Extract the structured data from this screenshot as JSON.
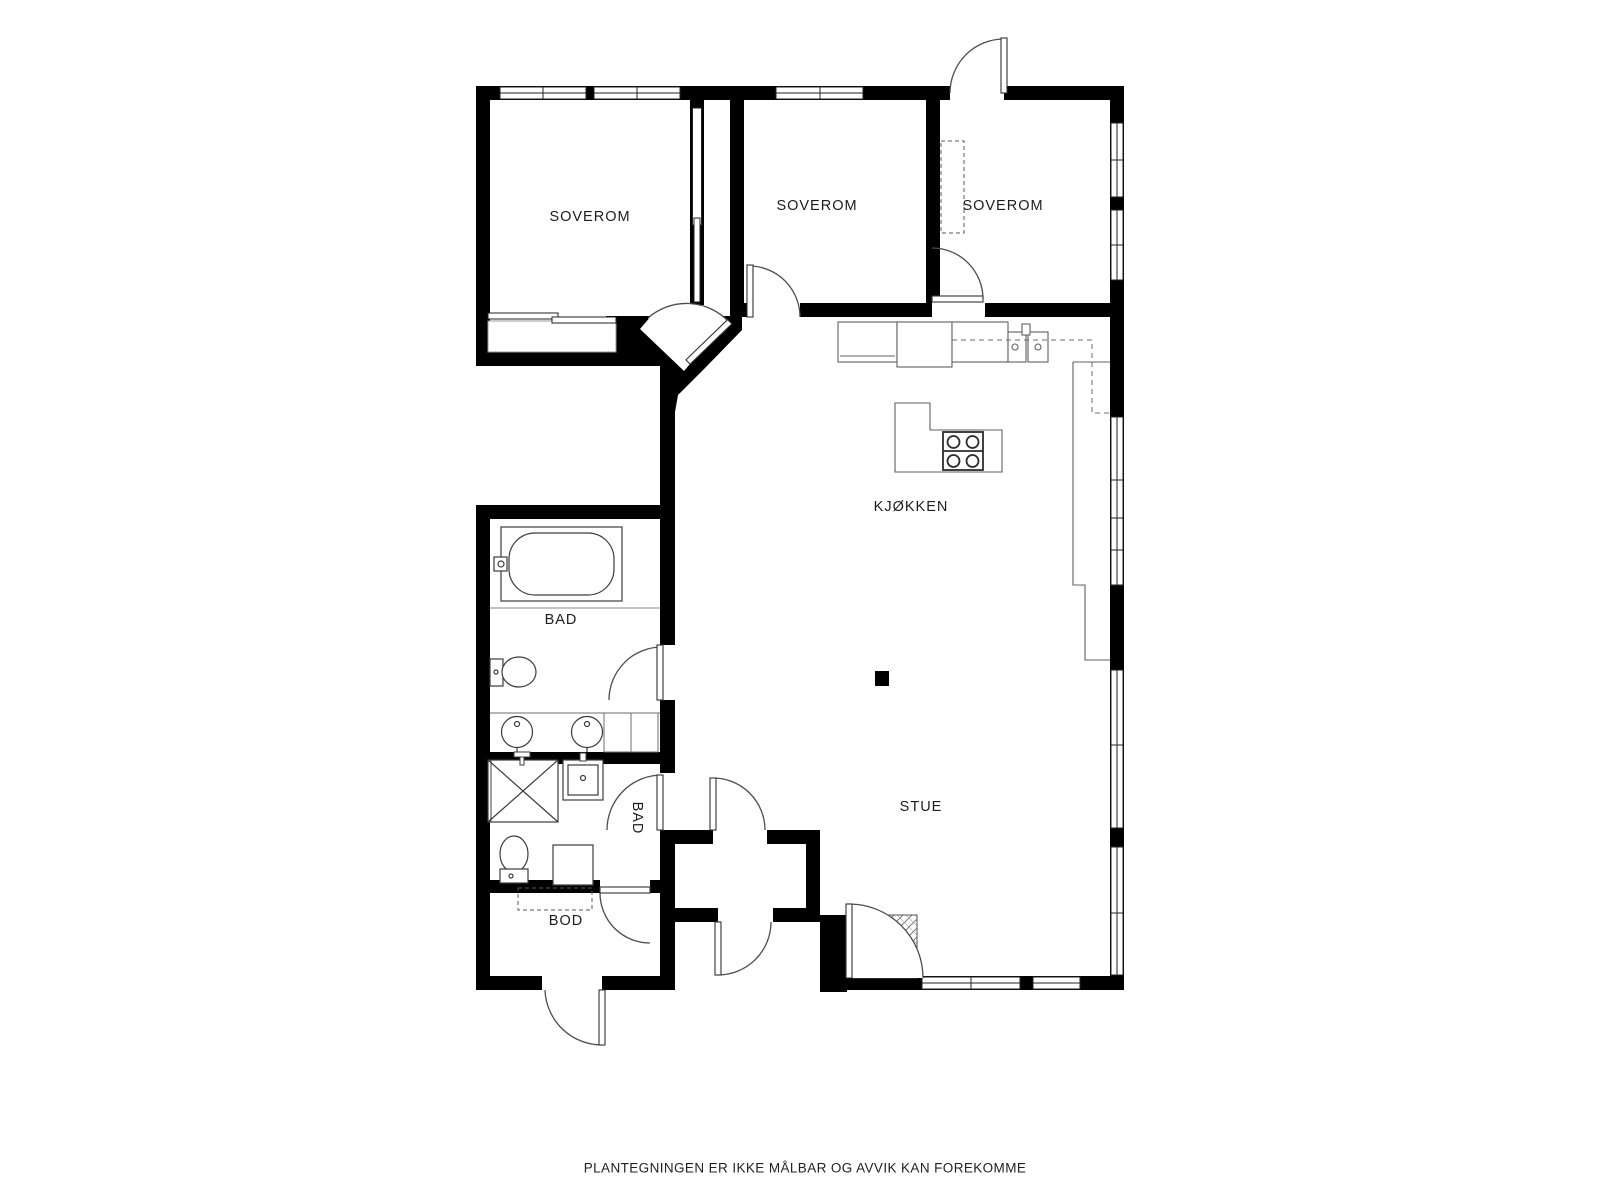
{
  "document": {
    "type": "floor-plan",
    "language": "norwegian",
    "background_color": "#ffffff",
    "wall_color": "#000000",
    "line_color": "#4a4a4a",
    "counter_line_color": "#6e6e6e",
    "label_color": "#1c1c1c"
  },
  "rooms": [
    {
      "id": "soverom-1",
      "label": "SOVEROM"
    },
    {
      "id": "soverom-2",
      "label": "SOVEROM"
    },
    {
      "id": "soverom-3",
      "label": "SOVEROM"
    },
    {
      "id": "kjokken",
      "label": "KJØKKEN"
    },
    {
      "id": "stue",
      "label": "STUE"
    },
    {
      "id": "bad-1",
      "label": "BAD"
    },
    {
      "id": "bad-2",
      "label": "BAD"
    },
    {
      "id": "bod",
      "label": "BOD"
    }
  ],
  "fixtures": [
    "bathtub",
    "toilet",
    "double-sink-vanity",
    "shower-cabin",
    "small-sink",
    "toilet-2",
    "washing-machine",
    "kitchen-sink",
    "cooktop-island",
    "refrigerator",
    "counter",
    "fireplace-column",
    "entry-mat",
    "wardrobe-dashed",
    "sliding-closet-doors",
    "pocket-door"
  ],
  "footer": {
    "disclaimer": "PLANTEGNINGEN ER IKKE MÅLBAR OG AVVIK KAN FOREKOMME"
  }
}
